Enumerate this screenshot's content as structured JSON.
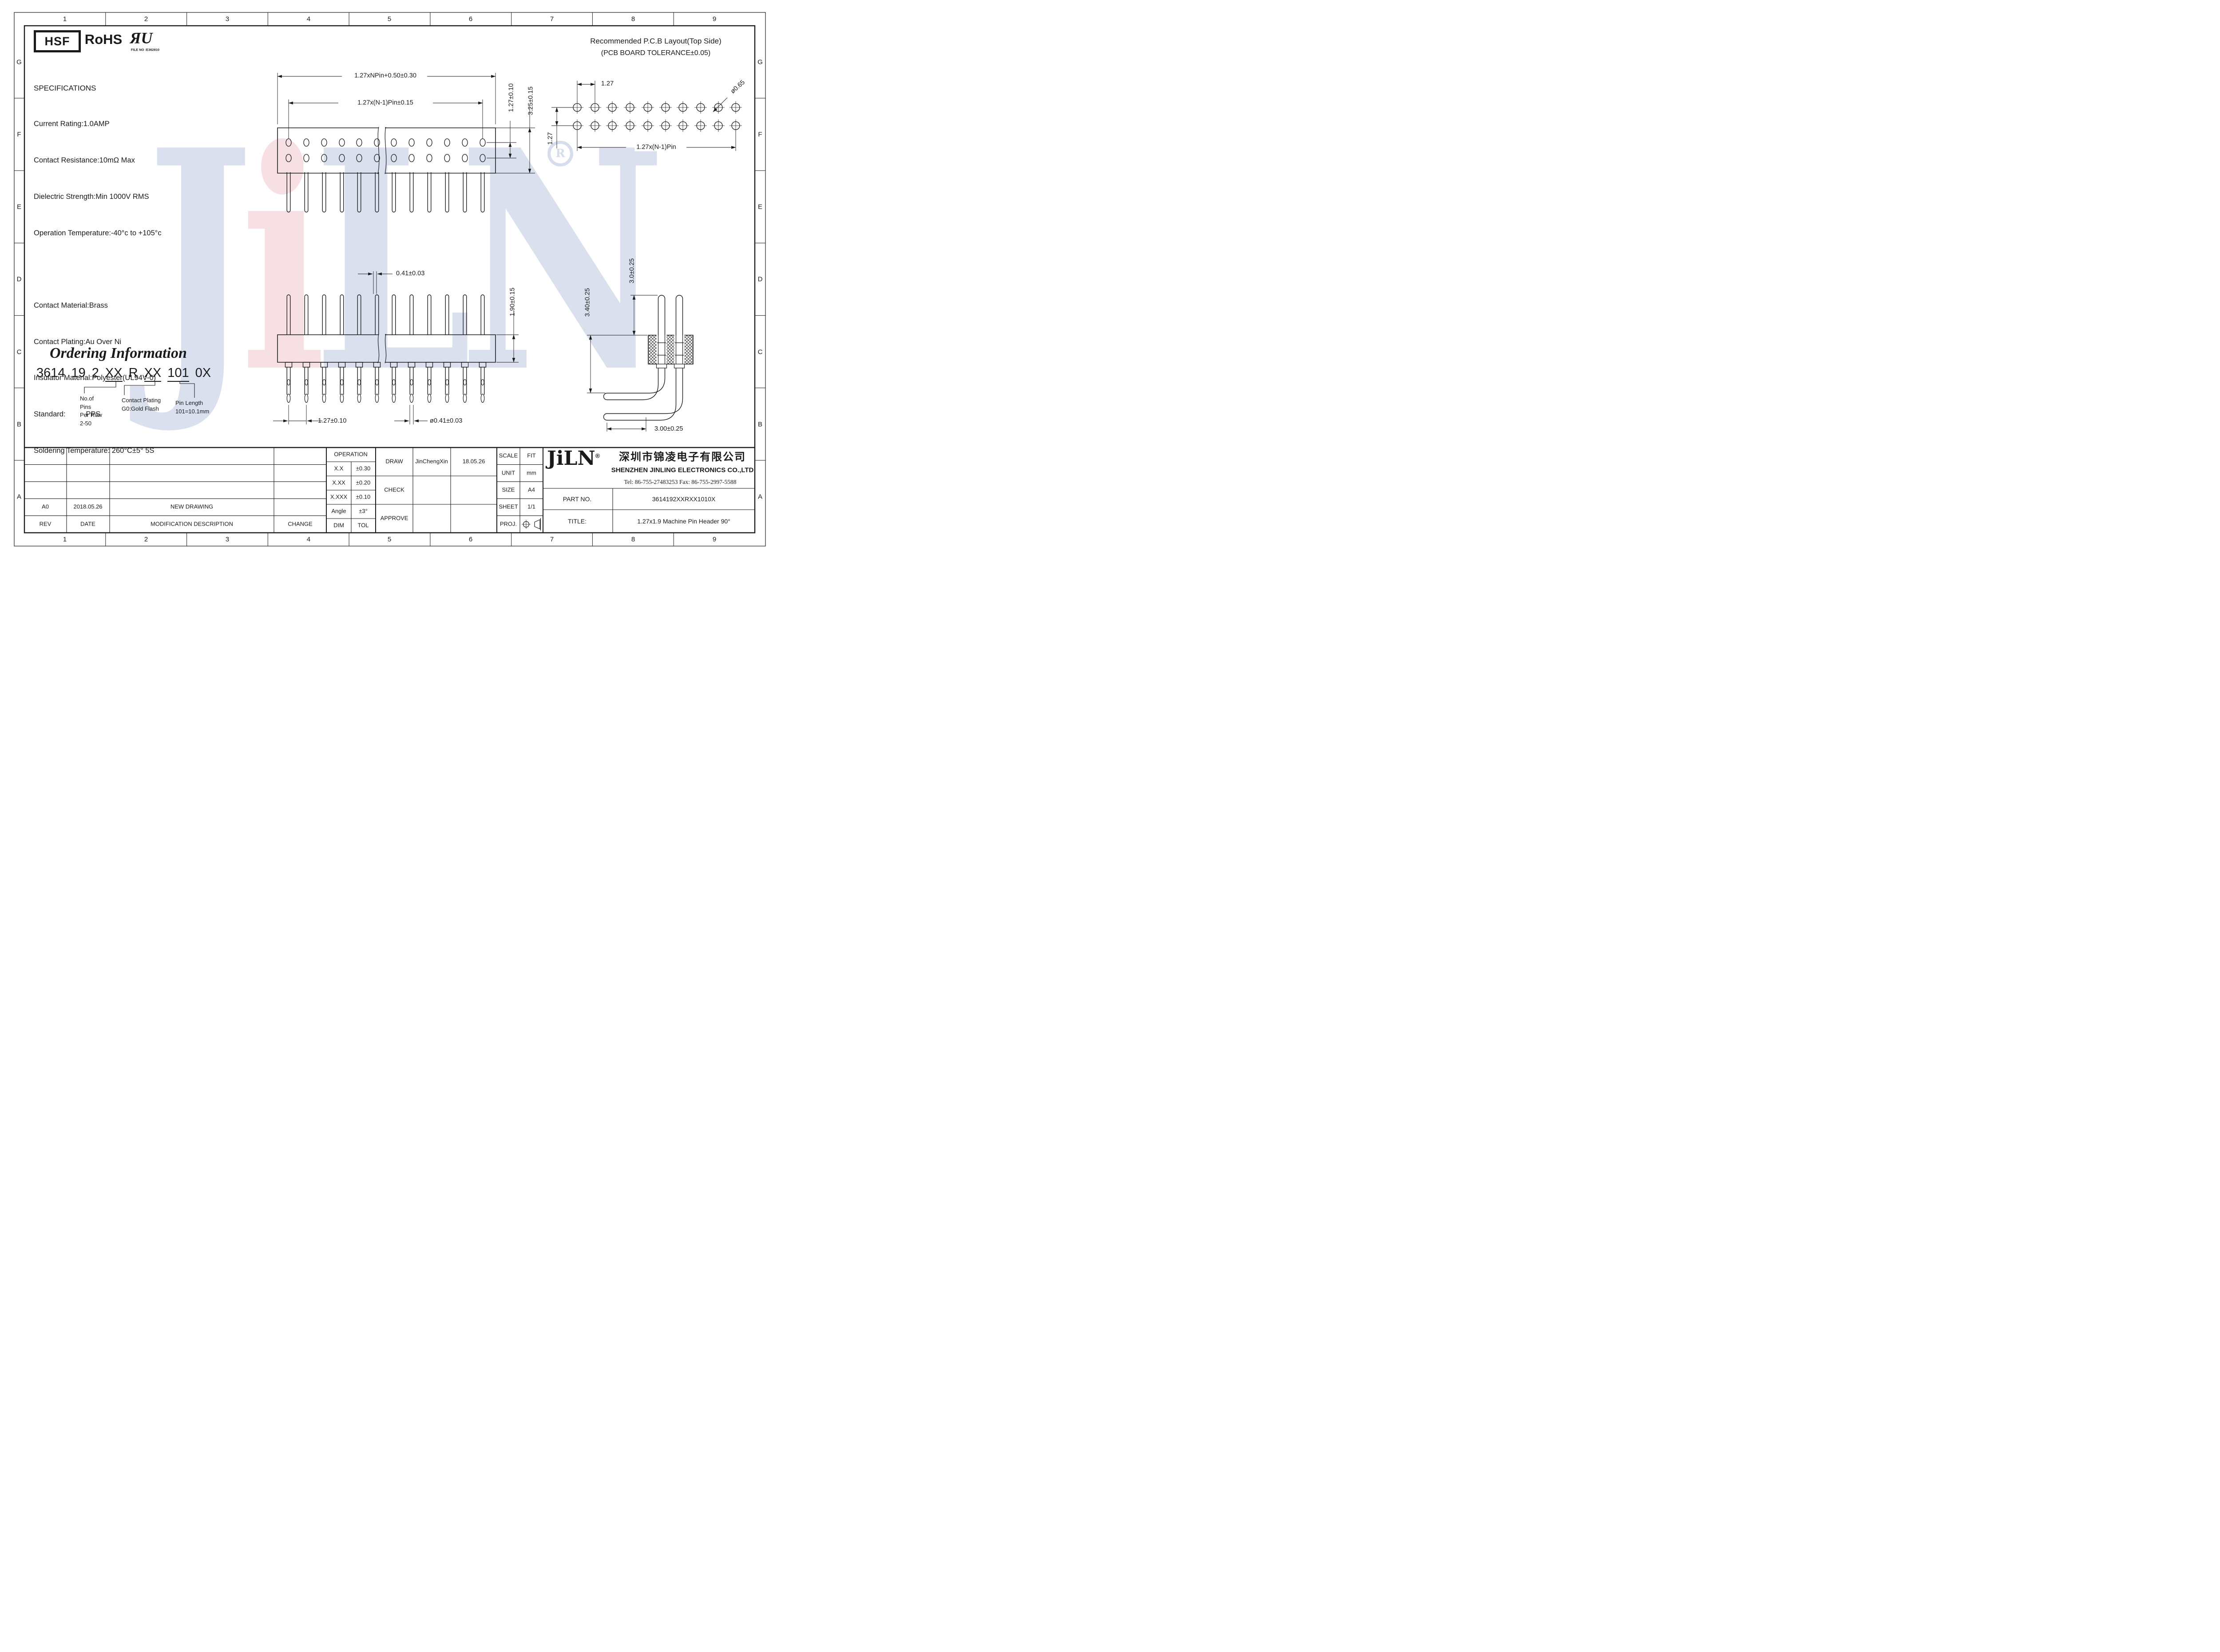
{
  "zones": {
    "columns": [
      "1",
      "2",
      "3",
      "4",
      "5",
      "6",
      "7",
      "8",
      "9"
    ],
    "rows": [
      "G",
      "F",
      "E",
      "D",
      "C",
      "B",
      "A"
    ]
  },
  "certifications": {
    "hsf": "HSF",
    "rohs": "RoHS",
    "ul_mark": "ЯU",
    "ul_file": "FILE NO :E362810"
  },
  "specifications": {
    "title": "SPECIFICATIONS",
    "electrical": [
      "Current Rating:1.0AMP",
      "Contact Resistance:10mΩ Max",
      "Dielectric Strength:Min 1000V RMS",
      "Operation Temperature:-40°c to +105°c"
    ],
    "material": [
      "Contact Material:Brass",
      "Contact Plating:Au Over Ni",
      "Insulator Material:Polyester(UL94V-0)",
      "Standard:          PPS",
      "Soldering Temperature: 260°C±5° 5S"
    ]
  },
  "pcb_layout": {
    "title": "Recommended P.C.B Layout(Top Side)",
    "subtitle": "(PCB BOARD TOLERANCE±0.05)",
    "dim_pitch_x": "1.27",
    "dim_hole_dia": "ø0.65",
    "dim_pitch_y": "1.27",
    "dim_span": "1.27x(N-1)Pin"
  },
  "front_view": {
    "dim_overall": "1.27xNPin+0.50±0.30",
    "dim_span": "1.27x(N-1)Pin±0.15",
    "dim_row_pitch": "1.27±0.10",
    "dim_height": "3.25±0.15"
  },
  "side_view": {
    "dim_pin_width": "0.41±0.03",
    "dim_body_height": "1.90±0.15",
    "dim_pitch": "1.27±0.10",
    "dim_pin_dia": "ø0.41±0.03"
  },
  "right_angle_view": {
    "dim_top_pin": "3.0±0.25",
    "dim_total_height": "3.40±0.25",
    "dim_lead_length": "3.00±0.25"
  },
  "ordering": {
    "title": "Ordering Information",
    "code": [
      "3614",
      "19",
      "2",
      "XX",
      "R",
      "XX",
      "101",
      "0X"
    ],
    "callout_pins": [
      "No.of",
      "Pins",
      "Per Row",
      "2-50"
    ],
    "callout_plating": [
      "Contact Plating",
      "G0:Gold Flash"
    ],
    "callout_length": [
      "Pin Length",
      "101=10.1mm"
    ]
  },
  "revision_table": {
    "headers": [
      "REV",
      "DATE",
      "MODIFICATION DESCRIPTION",
      "CHANGE"
    ],
    "row": {
      "rev": "A0",
      "date": "2018.05.26",
      "description": "NEW DRAWING"
    }
  },
  "tolerance_table": {
    "title": "OPERATION",
    "rows": [
      [
        "X.X",
        "±0.30"
      ],
      [
        "X.XX",
        "±0.20"
      ],
      [
        "X.XXX",
        "±0.10"
      ],
      [
        "Angle",
        "±3°"
      ],
      [
        "DIM",
        "TOL"
      ]
    ]
  },
  "approval": {
    "draw": "DRAW",
    "draw_by": "JinChengXin",
    "draw_date": "18.05.26",
    "check": "CHECK",
    "approve": "APPROVE"
  },
  "doc_info": {
    "scale_label": "SCALE",
    "scale": "FIT",
    "unit_label": "UNIT",
    "unit": "mm",
    "size_label": "SIZE",
    "size": "A4",
    "sheet_label": "SHEET",
    "sheet": "1/1",
    "proj_label": "PROJ."
  },
  "company": {
    "logo": "JiLN",
    "reg": "®",
    "name_cn": "深圳市锦凌电子有限公司",
    "name_en": "SHENZHEN JINLING ELECTRONICS CO.,LTD",
    "contact": "Tel: 86-755-27483253   Fax: 86-755-2997-5588",
    "part_no_label": "PART NO.",
    "part_no": "3614192XXRXX1010X",
    "title_label": "TITLE:",
    "drawing_title": "1.27x1.9 Machine Pin Header 90°"
  },
  "watermark": {
    "letters": [
      "J",
      "i",
      "L",
      "N"
    ],
    "reg": "R"
  }
}
